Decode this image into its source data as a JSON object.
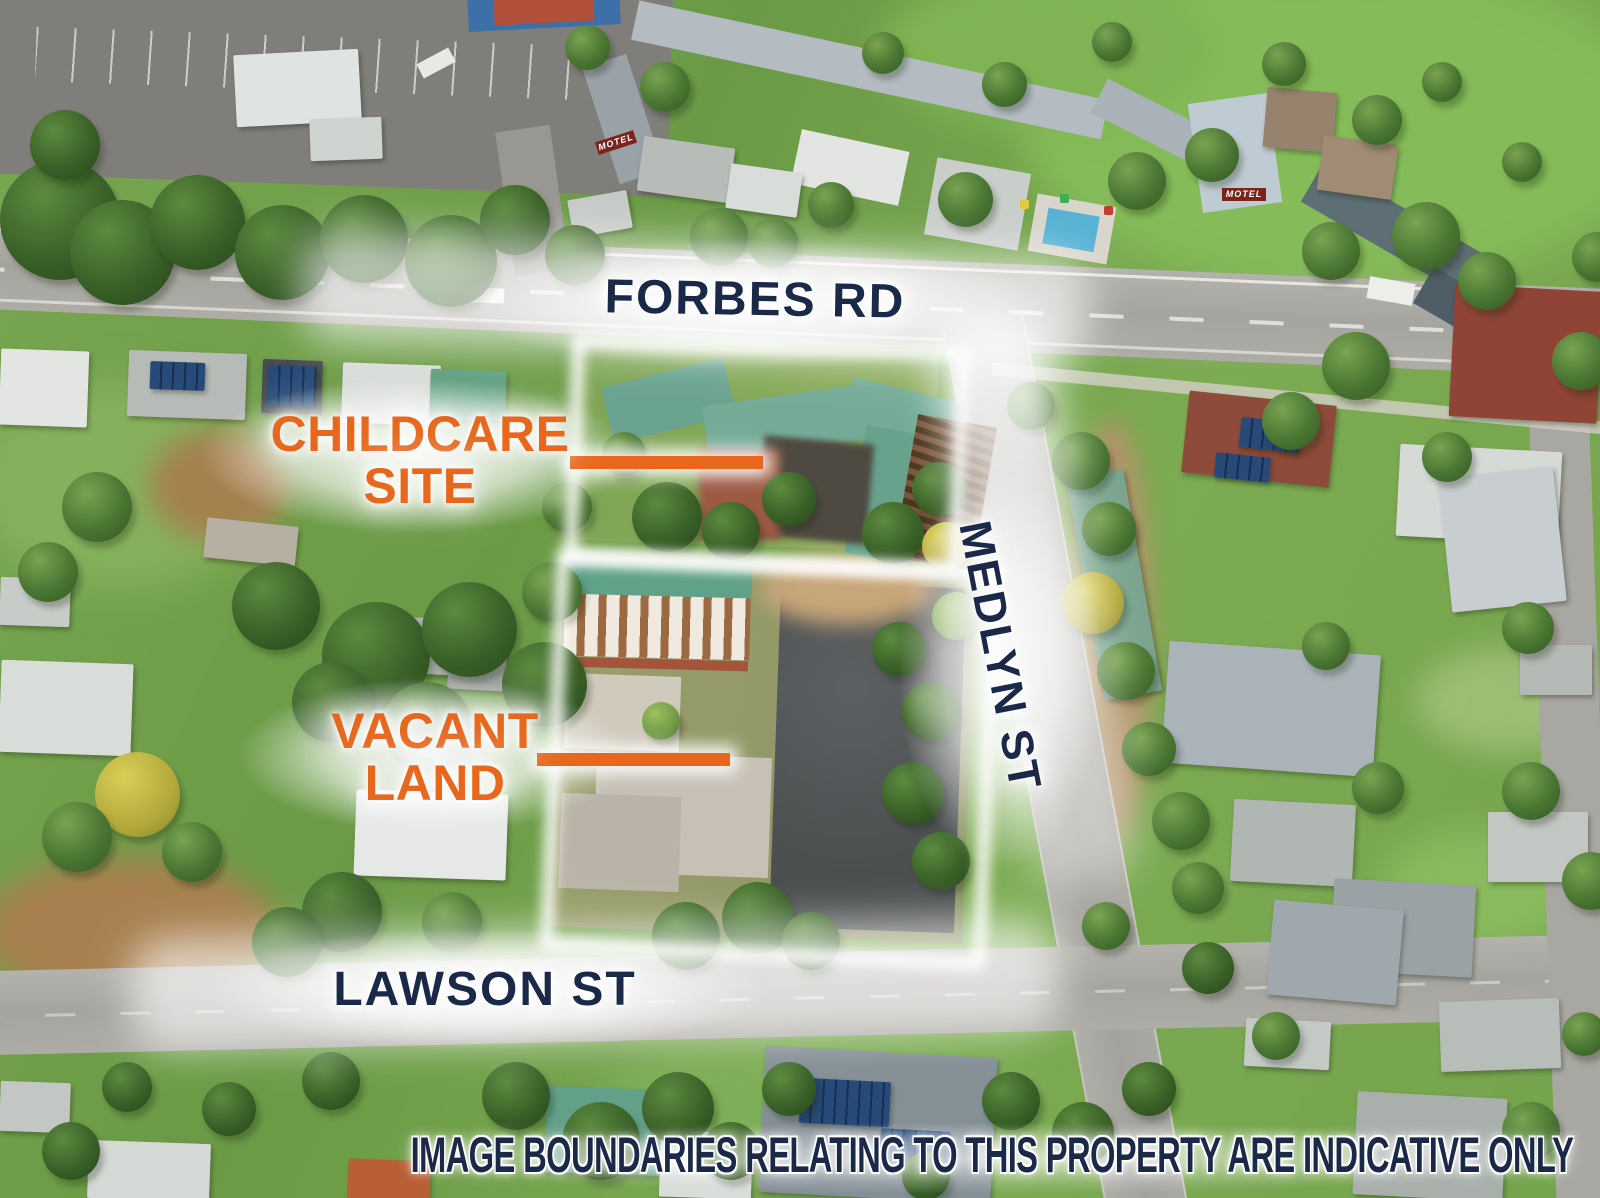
{
  "street_labels": {
    "top_road": "FORBES RD",
    "right_street": "MEDLYN ST",
    "bottom_street": "LAWSON ST"
  },
  "callouts": {
    "childcare": {
      "line1": "CHILDCARE",
      "line2": "SITE"
    },
    "vacant": {
      "line1": "VACANT",
      "line2": "LAND"
    }
  },
  "signs": {
    "motel_roof_sign": "MOTEL"
  },
  "disclaimer": "IMAGE BOUNDARIES RELATING TO THIS PROPERTY ARE INDICATIVE ONLY",
  "colors": {
    "callout_orange": "#E8671C",
    "street_label_navy": "#1B2949",
    "boundary_glow_white": "#FFFFFF"
  }
}
